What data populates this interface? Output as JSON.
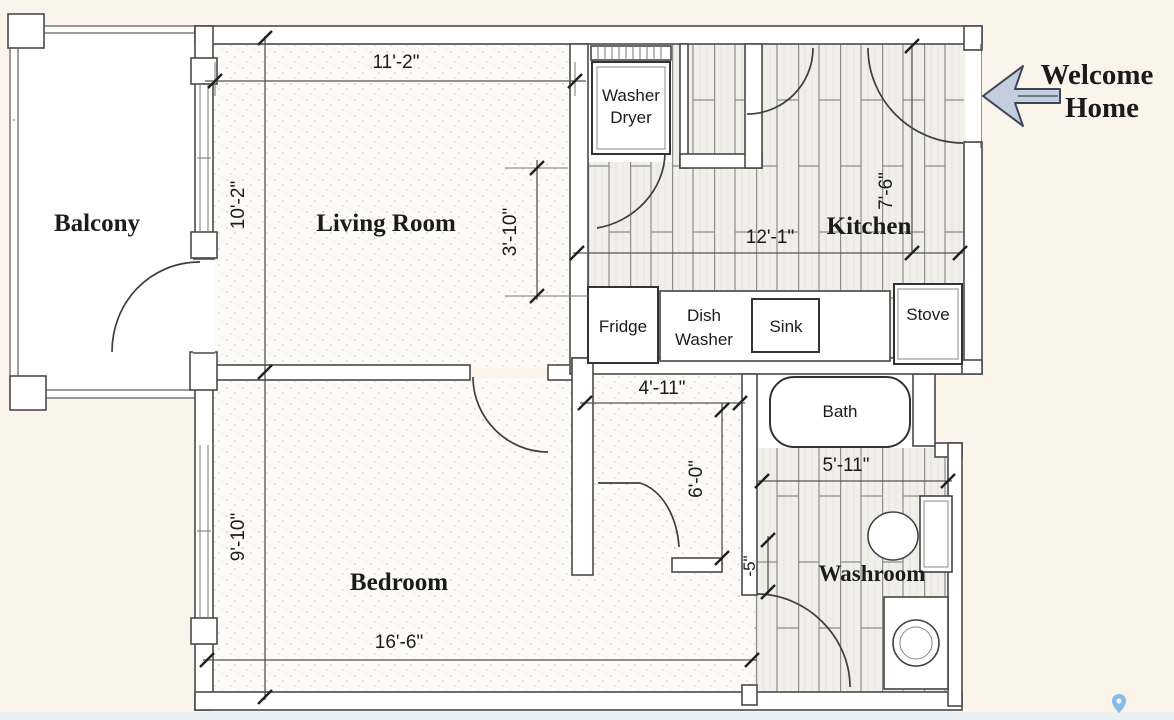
{
  "colors": {
    "background": "#faf4ea",
    "bottom_strip": "#eaeff2",
    "wall_line": "#4a4a4a",
    "plank_fill": "#f0efe9",
    "plank_line": "#8e8d88",
    "stipple_dot": "#c6c5bf",
    "arrow_fill": "#c3cdde",
    "arrow_outline": "#3c4658",
    "pin_blue": "#85bce8"
  },
  "welcome": {
    "line1": "Welcome",
    "line2": "Home"
  },
  "rooms": {
    "balcony": "Balcony",
    "living": "Living Room",
    "kitchen": "Kitchen",
    "bedroom": "Bedroom",
    "washroom": "Washroom"
  },
  "fixtures": {
    "washer_line1": "Washer",
    "washer_line2": "Dryer",
    "fridge": "Fridge",
    "dish_line1": "Dish",
    "dish_line2": "Washer",
    "sink": "Sink",
    "stove": "Stove",
    "bath": "Bath"
  },
  "dims": {
    "living_width": "11'-2\"",
    "living_height": "10'-2\"",
    "closet_height": "3'-10\"",
    "kitchen_width": "12'-1\"",
    "kitchen_height": "7'-6\"",
    "hall_width": "4'-11\"",
    "hall_height": "6'-0\"",
    "washroom_width": "5'-11\"",
    "washroom_door": "-5\"",
    "bedroom_height": "9'-10\"",
    "bedroom_width": "16'-6\""
  },
  "icons": {
    "map_pin": "map-pin"
  }
}
